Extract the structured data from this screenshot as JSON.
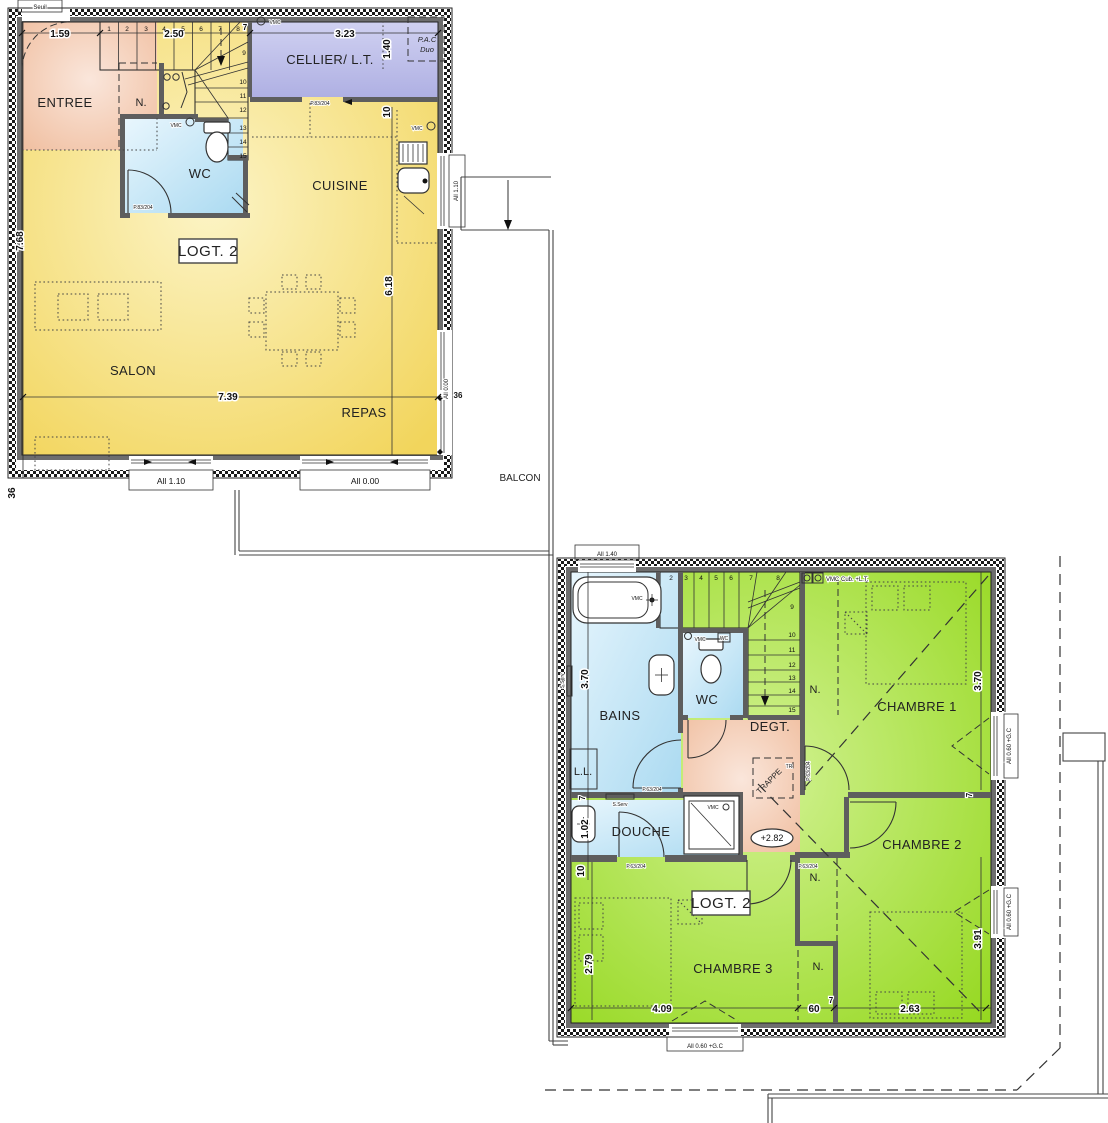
{
  "colors": {
    "wall": "#5E5E5E",
    "yellow": "#F3D75F",
    "green": "#98DA21",
    "blue": "#B5DFF3",
    "salmon": "#F2C3A8",
    "lavender": "#B4B5E6"
  },
  "f1": {
    "logt": "LOGT. 2",
    "rooms": {
      "entree": "ENTREE",
      "n": "N.",
      "wc": "WC",
      "cellier": "CELLIER/ L.T.",
      "cuisine": "CUISINE",
      "salon": "SALON",
      "repas": "REPAS",
      "balcon": "BALCON"
    },
    "equip": {
      "seuil": "Seuil",
      "pac1": "P.A.C",
      "pac2": "Duo",
      "vmc": "VMC"
    },
    "dims": {
      "d159": "1.59",
      "d250": "2.50",
      "d7": "7",
      "d323": "3.23",
      "d140": "1.40",
      "d10": "10",
      "d768": "7.68",
      "d618": "6.18",
      "d739": "7.39",
      "d36": "36"
    },
    "windows": {
      "w110": "All 1.10",
      "w000": "All 0.00"
    },
    "doors": {
      "p83": "P.83/204"
    },
    "steps": [
      "1",
      "2",
      "3",
      "4",
      "5",
      "6",
      "7",
      "8",
      "9",
      "10",
      "11",
      "12",
      "13",
      "14",
      "15"
    ]
  },
  "f2": {
    "logt": "LOGT. 2",
    "rooms": {
      "bains": "BAINS",
      "wc": "WC",
      "degt": "DEGT.",
      "douche": "DOUCHE",
      "ch1": "CHAMBRE 1",
      "ch2": "CHAMBRE 2",
      "ch3": "CHAMBRE 3",
      "n": "N.",
      "ll": "L.L."
    },
    "equip": {
      "vmc": "VMC",
      "wcd": "WC",
      "vmccub": "VMC Cub. +L.T.",
      "sserv": "S.Serv",
      "trappe": "TRAPPE",
      "tr": "TR",
      "level": "+2.82"
    },
    "dims": {
      "d370": "3.70",
      "d102": "1.02",
      "d10": "10",
      "d7": "7",
      "d279": "2.79",
      "d391": "3.91",
      "d409": "4.09",
      "d60": "60",
      "d263": "2.63"
    },
    "windows": {
      "w140": "All 1.40",
      "wgc": "All 0.60 +G.C"
    },
    "doors": {
      "p63": "P.63/204"
    },
    "steps": [
      "2",
      "3",
      "4",
      "5",
      "6",
      "7",
      "8",
      "9",
      "10",
      "11",
      "12",
      "13",
      "14",
      "15"
    ]
  }
}
